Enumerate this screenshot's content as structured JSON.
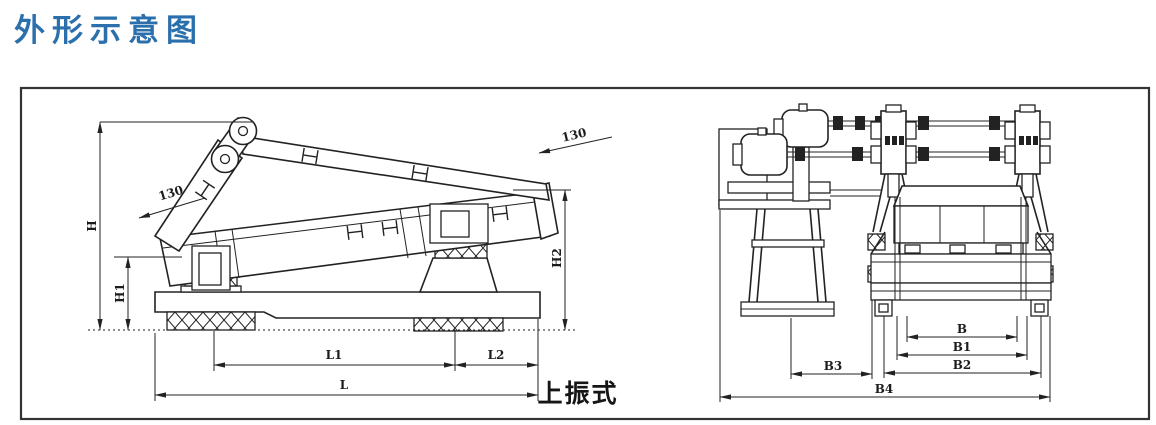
{
  "title": {
    "text": "外形示意图",
    "color": "#2b6fad"
  },
  "drawing": {
    "type_label": "上振式",
    "side_view": {
      "dims": {
        "H": "H",
        "H1": "H1",
        "H2": "H2",
        "L": "L",
        "L1": "L1",
        "L2": "L2"
      },
      "angles": {
        "left": "130",
        "right": "130"
      }
    },
    "end_view": {
      "dims": {
        "B": "B",
        "B1": "B1",
        "B2": "B2",
        "B3": "B3",
        "B4": "B4"
      }
    }
  }
}
